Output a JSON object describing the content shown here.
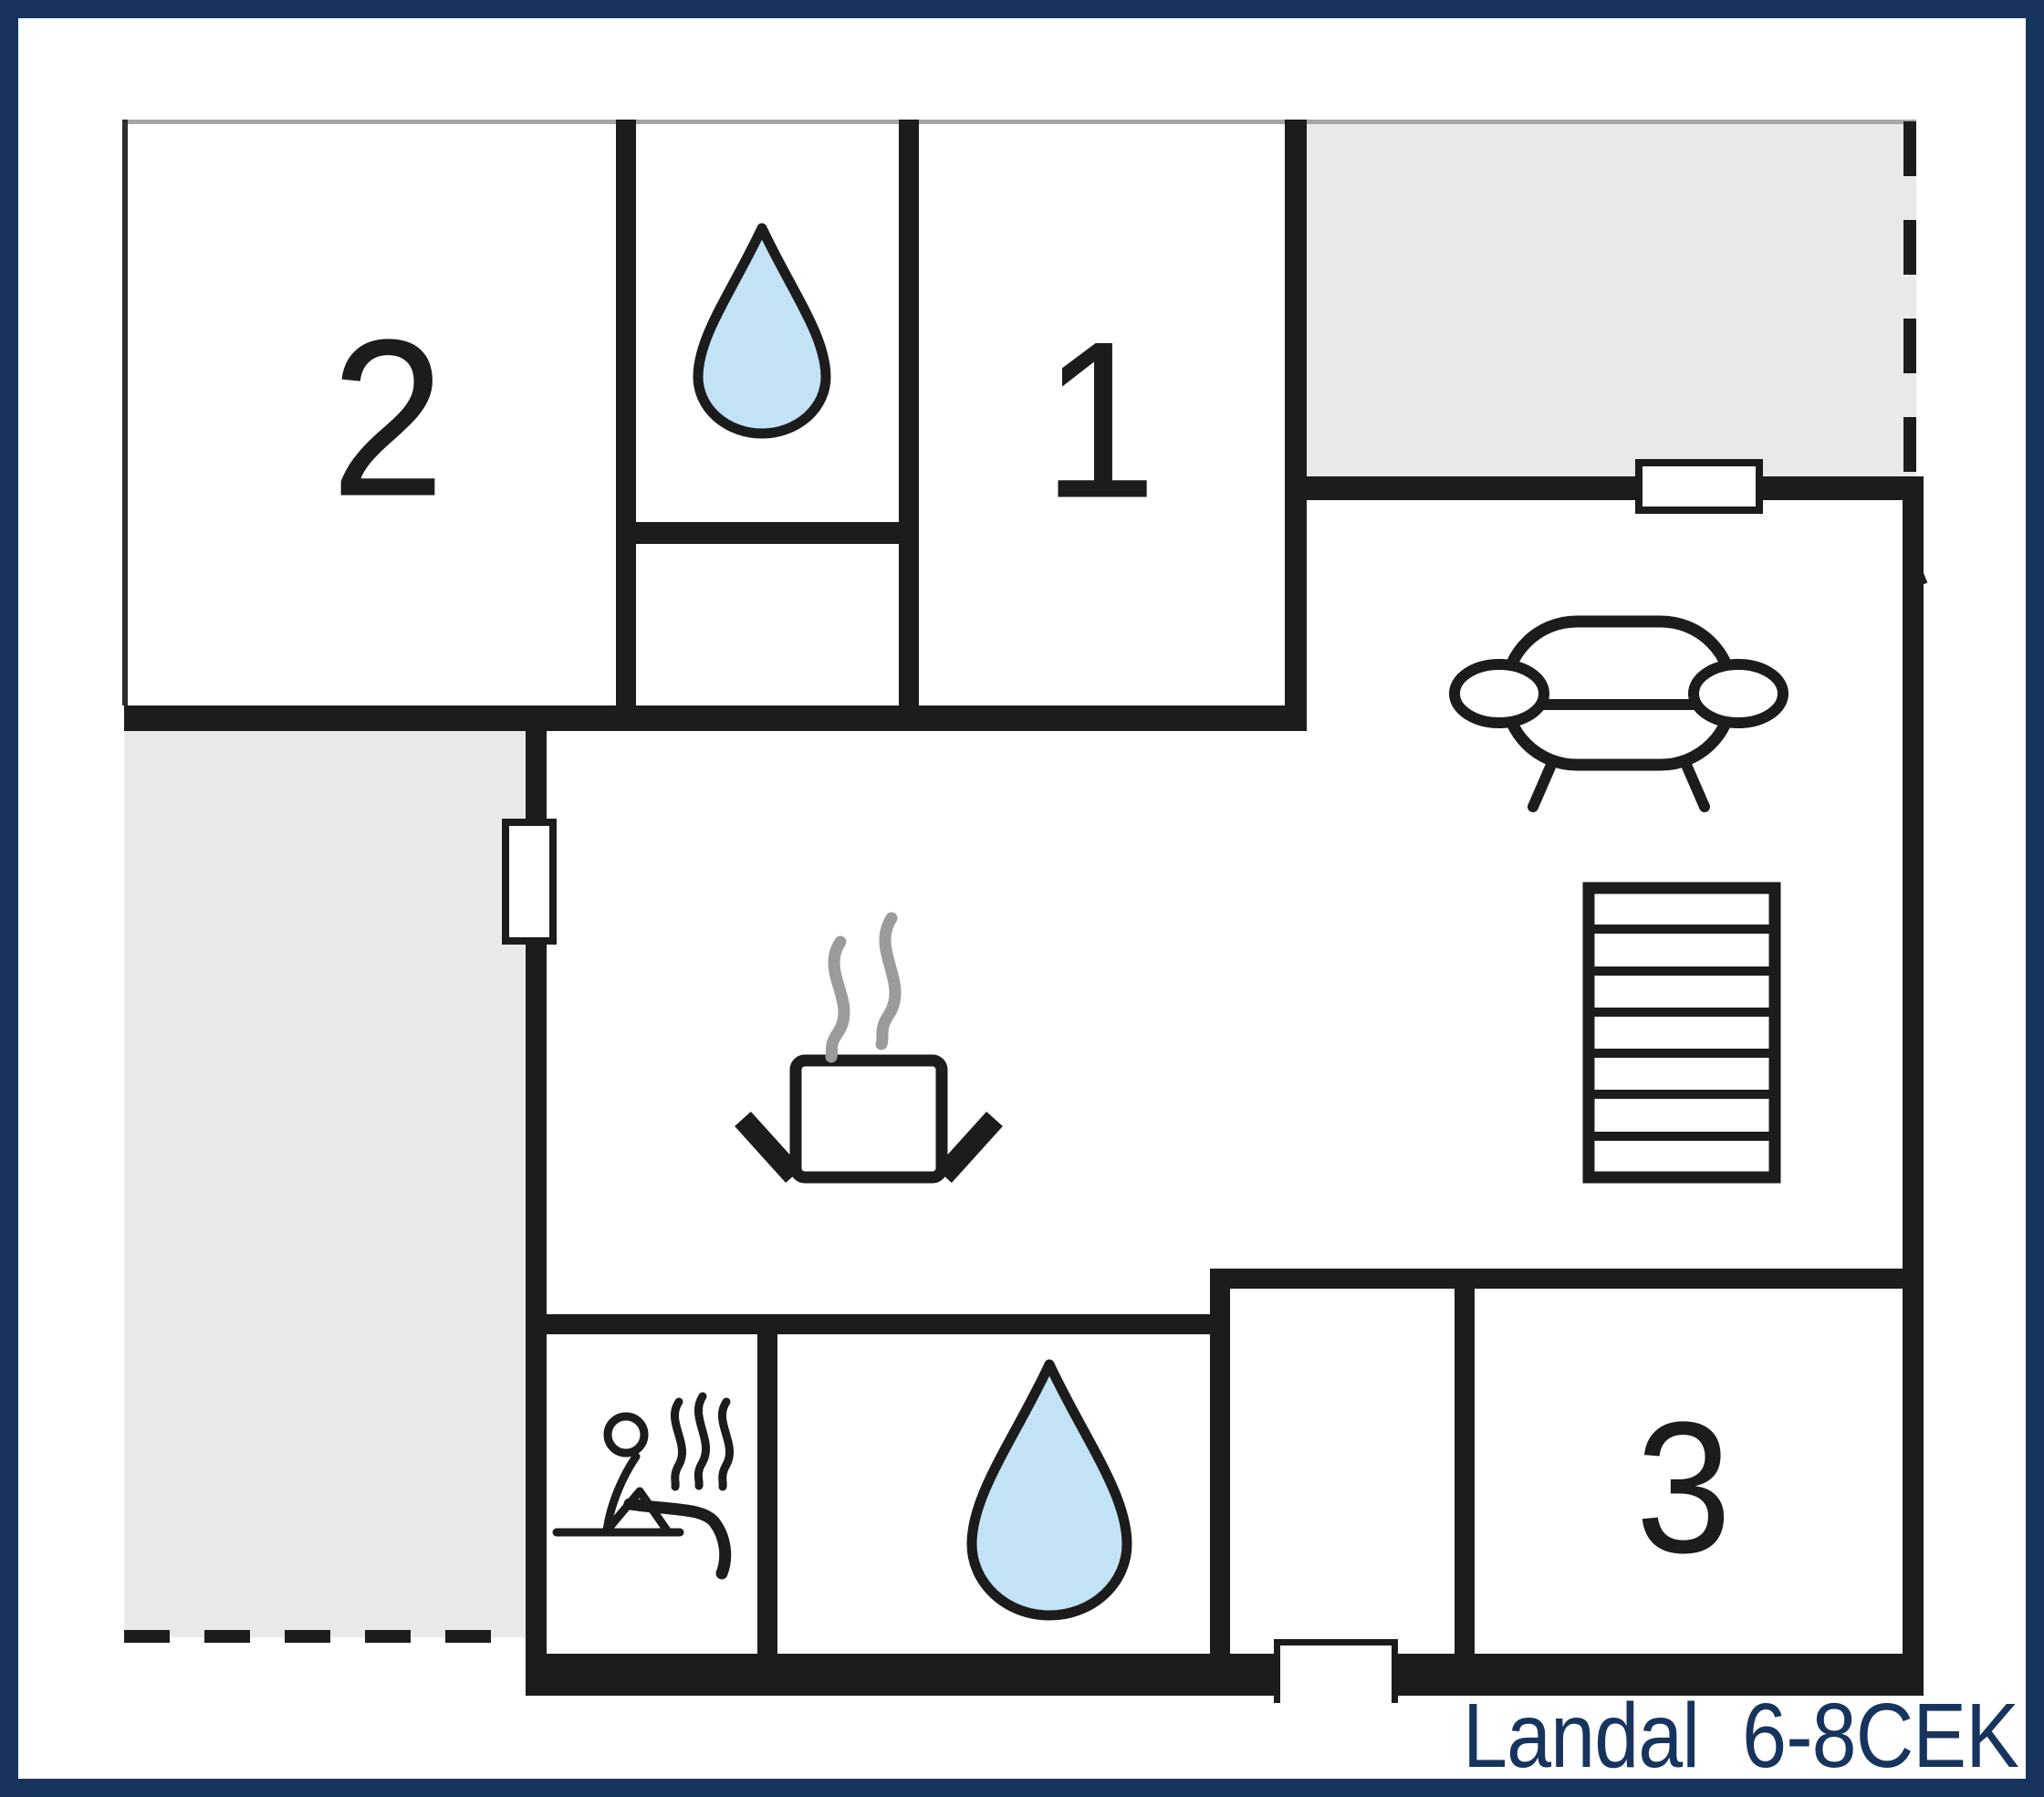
{
  "floorplan": {
    "footer_label": "Landal  6-8CEK",
    "rooms": [
      {
        "id": "room-2",
        "number": "2"
      },
      {
        "id": "room-1",
        "number": "1"
      },
      {
        "id": "room-3",
        "number": "3"
      }
    ],
    "icons": {
      "bathroom_top": "water-drop-icon",
      "bathroom_bottom": "water-drop-icon",
      "sauna": "sauna-person-steam-icon",
      "kitchen": "steaming-pot-icon",
      "living_room": "sofa-icon",
      "stairs": "stairs-icon"
    },
    "colors": {
      "frame": "#17345e",
      "walls": "#1c1c1c",
      "outdoor_gray": "#e9e9e7",
      "water_blue": "#c2e2f5",
      "steam_gray": "#9b9b9b",
      "label_navy": "#17345e"
    }
  }
}
